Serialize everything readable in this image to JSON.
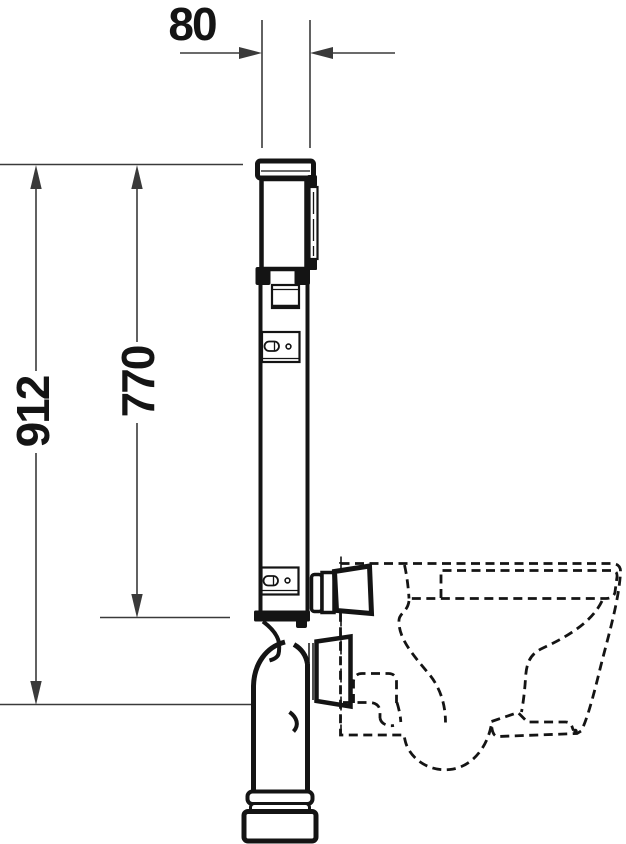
{
  "colors": {
    "ink": "#141414",
    "dimension": "#3a3a3a",
    "background": "#ffffff"
  },
  "dimensions": {
    "depth": "80",
    "total_height": "912",
    "frame_height": "770"
  }
}
